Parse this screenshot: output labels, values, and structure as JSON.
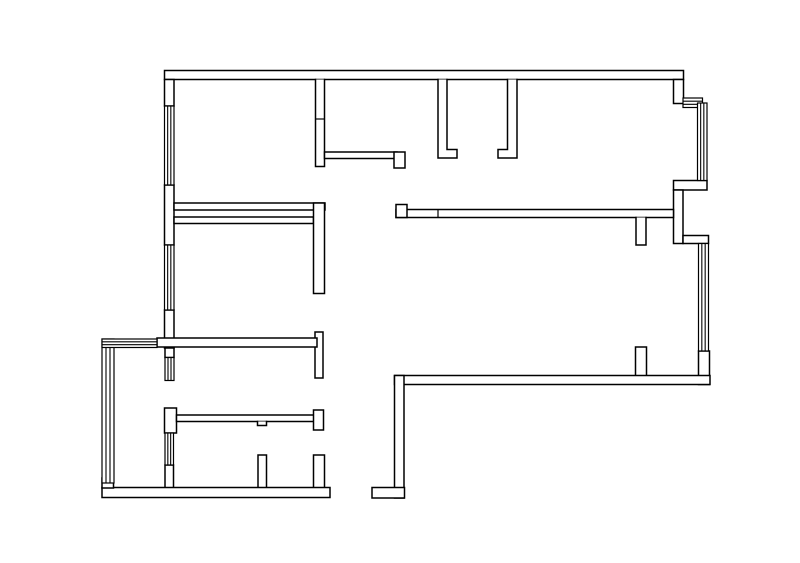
{
  "title": "Apartment floor plan line drawing",
  "canvas": {
    "width": 800,
    "height": 563,
    "background": "#ffffff",
    "line_color": "#000000"
  },
  "floorplan": {
    "walls": [
      {
        "id": "top-wall",
        "x": 164.5,
        "y": 70.5,
        "w": 519,
        "h": 9
      },
      {
        "id": "left-wall-upper",
        "x": 164.5,
        "y": 79.5,
        "w": 9.5,
        "h": 26.5
      },
      {
        "id": "left-wall-mid-a",
        "x": 164.5,
        "y": 185,
        "w": 9.5,
        "h": 60
      },
      {
        "id": "left-wall-mid-b",
        "x": 164.5,
        "y": 310,
        "w": 9.5,
        "h": 38
      },
      {
        "id": "left-wall-low-a",
        "x": 165,
        "y": 348,
        "w": 9,
        "h": 9.5
      },
      {
        "id": "left-cap-bottom-room",
        "x": 164.5,
        "y": 408,
        "w": 12,
        "h": 25
      },
      {
        "id": "left-wall-low-b",
        "x": 165,
        "y": 465,
        "w": 8.5,
        "h": 23
      },
      {
        "id": "room1-right-wall",
        "points": [
          [
            315.5,
            79.5
          ],
          [
            315.5,
            166.5
          ],
          [
            324.5,
            166.5
          ],
          [
            324.5,
            79.5
          ]
        ]
      },
      {
        "id": "room1-bottom-wall",
        "x": 174,
        "y": 203,
        "w": 151,
        "h": 7
      },
      {
        "id": "midroom-top-wall",
        "x": 174,
        "y": 217,
        "w": 139.5,
        "h": 6.5
      },
      {
        "id": "hall-left-wall-a",
        "x": 313.5,
        "y": 203,
        "w": 11,
        "h": 90.5
      },
      {
        "id": "hall-left-wall-b",
        "x": 315,
        "y": 332,
        "w": 8,
        "h": 46
      },
      {
        "id": "hall-left-wall-c",
        "points": [
          [
            313.5,
            488
          ],
          [
            313.5,
            455
          ],
          [
            324.5,
            455
          ],
          [
            324.5,
            488
          ]
        ]
      },
      {
        "id": "midroom-bottom-wall",
        "x": 157,
        "y": 338,
        "w": 160,
        "h": 9
      },
      {
        "id": "room2-bottom-wall",
        "x": 324.5,
        "y": 152,
        "w": 72.5,
        "h": 6.5
      },
      {
        "id": "room2-bottom-cap",
        "x": 394,
        "y": 152,
        "w": 11,
        "h": 16
      },
      {
        "id": "door-jamb-left",
        "points": [
          [
            438,
            79.5
          ],
          [
            438,
            158
          ],
          [
            457,
            158
          ],
          [
            457,
            149.5
          ],
          [
            447,
            149.5
          ],
          [
            447,
            79.5
          ]
        ]
      },
      {
        "id": "door-jamb-right",
        "points": [
          [
            517,
            79.5
          ],
          [
            517,
            158
          ],
          [
            498,
            158
          ],
          [
            498,
            149.5
          ],
          [
            507.5,
            149.5
          ],
          [
            507.5,
            79.5
          ]
        ]
      },
      {
        "id": "topright-corner-wall",
        "x": 673.5,
        "y": 79.5,
        "w": 10,
        "h": 24
      },
      {
        "id": "bay-bottom-wall",
        "x": 673.5,
        "y": 180.5,
        "w": 33.5,
        "h": 9.5
      },
      {
        "id": "right-wall-upper",
        "x": 673.5,
        "y": 190,
        "w": 9.5,
        "h": 53.5
      },
      {
        "id": "right-jog-wall",
        "x": 683,
        "y": 235.5,
        "w": 25.5,
        "h": 8
      },
      {
        "id": "right-wall-lower",
        "x": 698.5,
        "y": 351,
        "w": 11,
        "h": 33.5
      },
      {
        "id": "livingroom-top-wall",
        "x": 396,
        "y": 209.5,
        "w": 277.5,
        "h": 8
      },
      {
        "id": "livingroom-top-cap",
        "x": 396,
        "y": 204.5,
        "w": 11,
        "h": 13
      },
      {
        "id": "dining-stub-top",
        "points": [
          [
            636,
            217.5
          ],
          [
            636,
            245
          ],
          [
            646,
            245
          ],
          [
            646,
            217.5
          ]
        ]
      },
      {
        "id": "dining-stub-bottom",
        "points": [
          [
            635.5,
            375.5
          ],
          [
            635.5,
            347
          ],
          [
            646.5,
            347
          ],
          [
            646.5,
            375.5
          ]
        ]
      },
      {
        "id": "livingroom-bottom-wall",
        "x": 394.5,
        "y": 375.5,
        "w": 315.5,
        "h": 9
      },
      {
        "id": "entry-corridor-wall",
        "x": 394.5,
        "y": 375.5,
        "w": 9.5,
        "h": 122.5
      },
      {
        "id": "entry-foot-wall",
        "x": 372,
        "y": 487.5,
        "w": 32.5,
        "h": 10.5
      },
      {
        "id": "bottomroom-top-wall",
        "x": 176.5,
        "y": 415,
        "w": 140.5,
        "h": 6.5
      },
      {
        "id": "bottomroom-top-cap",
        "x": 313.5,
        "y": 410,
        "w": 10,
        "h": 20
      },
      {
        "id": "bottomroom-top-notch",
        "points": [
          [
            257.5,
            421.5
          ],
          [
            257.5,
            425.5
          ],
          [
            266.5,
            425.5
          ],
          [
            266.5,
            421.5
          ]
        ]
      },
      {
        "id": "bathroom-divider-stub",
        "points": [
          [
            258,
            487.5
          ],
          [
            258,
            455
          ],
          [
            266.5,
            455
          ],
          [
            266.5,
            487.5
          ]
        ]
      },
      {
        "id": "bottom-wall",
        "x": 102,
        "y": 487.5,
        "w": 228,
        "h": 10
      },
      {
        "id": "balcony-corner-post",
        "x": 102,
        "y": 478,
        "w": 11.5,
        "h": 10
      }
    ],
    "windows": [
      {
        "id": "window-bedroom1-left",
        "orient": "v",
        "x": 164.5,
        "y": 106,
        "w": 9.5,
        "h": 79
      },
      {
        "id": "window-bedroom2-left",
        "orient": "v",
        "x": 164.5,
        "y": 245,
        "w": 9.5,
        "h": 65
      },
      {
        "id": "window-balcony-door",
        "orient": "v",
        "x": 165,
        "y": 357.5,
        "w": 9,
        "h": 23
      },
      {
        "id": "window-bathroom-left",
        "orient": "v",
        "x": 165,
        "y": 433,
        "w": 8.5,
        "h": 32
      },
      {
        "id": "window-bay-top",
        "orient": "h",
        "x": 683,
        "y": 98,
        "w": 19.5,
        "h": 9.5
      },
      {
        "id": "window-bay-right",
        "orient": "v",
        "x": 697.5,
        "y": 103,
        "w": 9.5,
        "h": 77.5
      },
      {
        "id": "window-livingroom-right",
        "orient": "v",
        "x": 698.5,
        "y": 243.5,
        "w": 10,
        "h": 107.5
      },
      {
        "id": "window-balcony-left",
        "orient": "v",
        "x": 102,
        "y": 339,
        "w": 12,
        "h": 144
      },
      {
        "id": "window-balcony-top",
        "orient": "h",
        "x": 102,
        "y": 339,
        "w": 55,
        "h": 8.5
      }
    ],
    "ticks": [
      {
        "id": "joint-room1-right-wall",
        "x1": 315.5,
        "y1": 119,
        "x2": 324.5,
        "y2": 119
      },
      {
        "id": "joint-livingroom-top-wall",
        "x1": 438,
        "y1": 209.5,
        "x2": 438,
        "y2": 217.5
      }
    ]
  }
}
